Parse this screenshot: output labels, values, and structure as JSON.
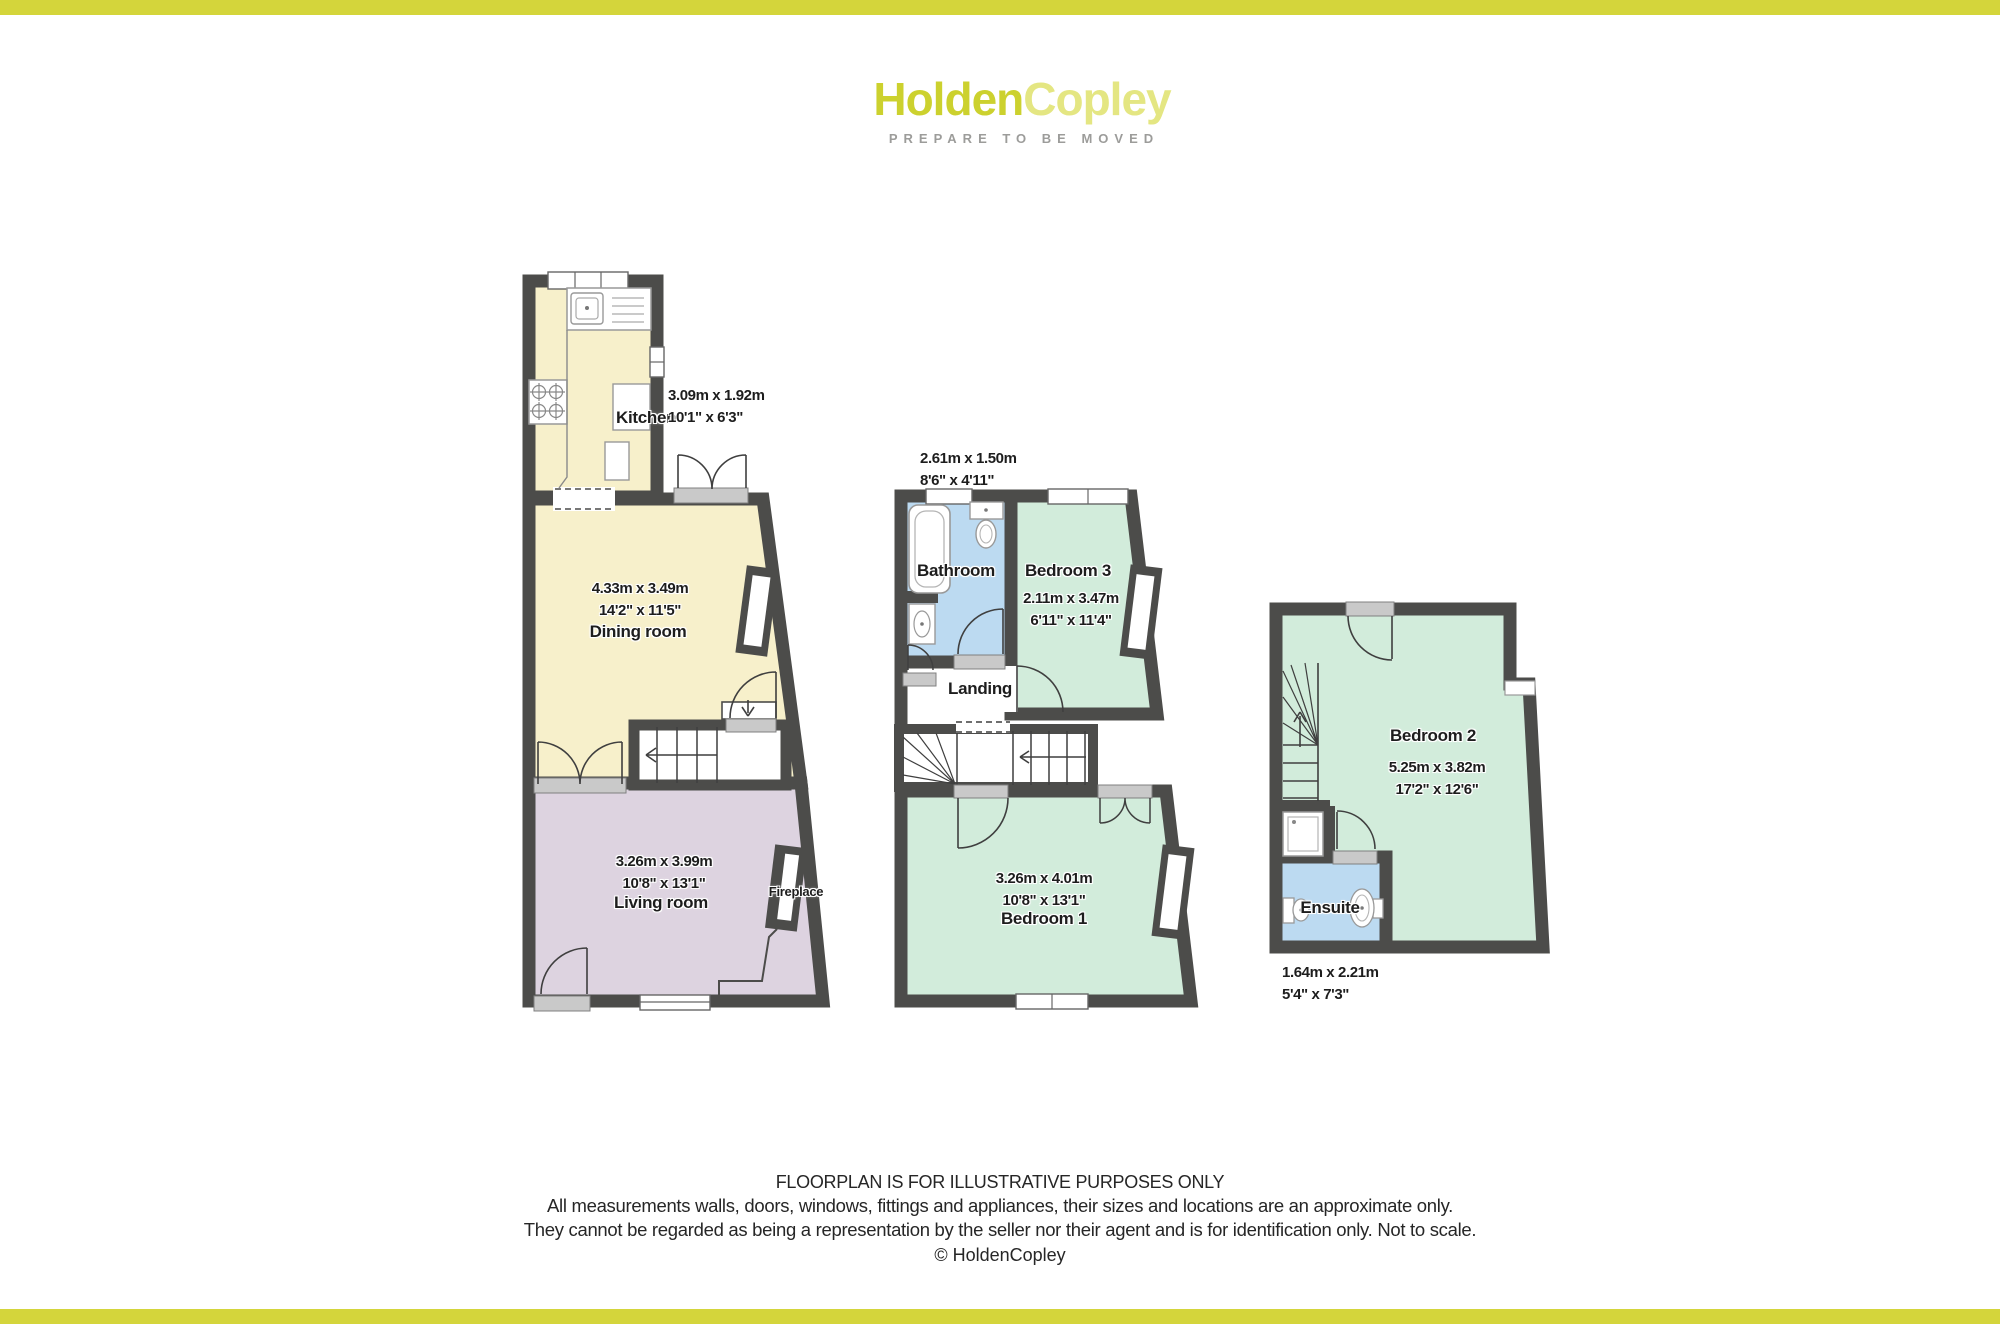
{
  "brand": {
    "name_primary": "Holden",
    "name_secondary": "Copley",
    "tagline": "PREPARE TO BE MOVED",
    "primary_color": "#ccd12e",
    "secondary_color": "#e4e682",
    "bar_color": "#d4d53b"
  },
  "colors": {
    "wall": "#4c4c4a",
    "room_cream": "#f7f0cb",
    "room_mauve": "#ddd3e0",
    "room_green": "#d2ecdb",
    "room_blue": "#bcdaf1",
    "threshold_gray": "#c9c9c9"
  },
  "floors": {
    "ground": {
      "kitchen": {
        "label": "Kitchen",
        "metric": "3.09m x 1.92m",
        "imperial": "10'1\" x 6'3\""
      },
      "dining": {
        "label": "Dining room",
        "metric": "4.33m x 3.49m",
        "imperial": "14'2\" x 11'5\""
      },
      "living": {
        "label": "Living room",
        "metric": "3.26m x 3.99m",
        "imperial": "10'8\" x 13'1\""
      },
      "fireplace": {
        "label": "Fireplace"
      }
    },
    "first": {
      "bathroom": {
        "label": "Bathroom",
        "metric": "2.61m x 1.50m",
        "imperial": "8'6\" x 4'11\""
      },
      "bedroom3": {
        "label": "Bedroom 3",
        "metric": "2.11m x 3.47m",
        "imperial": "6'11\" x 11'4\""
      },
      "landing": {
        "label": "Landing"
      },
      "bedroom1": {
        "label": "Bedroom 1",
        "metric": "3.26m x 4.01m",
        "imperial": "10'8\" x 13'1\""
      }
    },
    "second": {
      "bedroom2": {
        "label": "Bedroom 2",
        "metric": "5.25m x 3.82m",
        "imperial": "17'2\" x 12'6\""
      },
      "ensuite": {
        "label": "Ensuite",
        "metric": "1.64m x 2.21m",
        "imperial": "5'4\" x 7'3\""
      }
    }
  },
  "footer": {
    "line1": "FLOORPLAN IS FOR ILLUSTRATIVE PURPOSES ONLY",
    "line2": "All measurements walls, doors, windows, fittings and appliances, their sizes and locations are an approximate only.",
    "line3": "They cannot be regarded as being a representation by the seller nor their agent and is for identification only. Not to scale.",
    "copyright": "© HoldenCopley"
  }
}
